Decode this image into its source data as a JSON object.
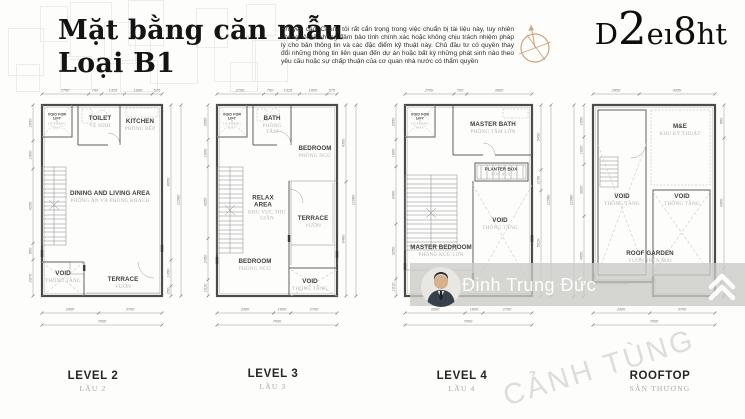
{
  "header": {
    "title_line1": "Mặt bằng căn mẫu",
    "title_line2": "Loại B1",
    "disclaimer": "Khuyến cáo: Chúng tôi rất cẩn trọng trong việc chuẩn bị tài liệu này, tuy nhiên chúng tôi sẽ không đảm bảo tính chính xác hoặc không chịu trách nhiệm pháp lý cho bản thông tin và các đặc điểm kỹ thuật này. Chủ đầu tư có quyền thay đổi những thông tin liên quan đến dự án hoặc bất kỳ những phát sinh nào theo yêu cầu hoặc sự chấp thuận của cơ quan nhà nước có thẩm quyền",
    "logo_parts": [
      "D",
      "2",
      "eı",
      "8",
      "ht"
    ]
  },
  "watermark": {
    "agent_name": "Đinh Trung Đức",
    "diagonal_text": "CẢNH TÙNG"
  },
  "colors": {
    "compass_tan": "#cfa27c",
    "watermark_bar": "#cbcac6"
  },
  "plans": [
    {
      "label": "LEVEL 2",
      "label_vn": "LẦU 2",
      "rooms": {
        "lift_en": "VOID FOR LIFT",
        "lift_vn": "LÔ THANG MÁY",
        "toilet_en": "TOILET",
        "toilet_vn": "VỆ SINH",
        "kitchen_en": "KITCHEN",
        "kitchen_vn": "PHÒNG BẾP",
        "dining_en": "DINING AND LIVING AREA",
        "dining_vn": "PHÒNG ĂN VÀ PHÒNG KHÁCH",
        "void_en": "VOID",
        "void_vn": "THÔNG TẦNG",
        "terrace_en": "TERRACE",
        "terrace_vn": "VƯỜN"
      },
      "dims_top": [
        "2700",
        "760",
        "1325",
        "1600",
        "575"
      ],
      "dims_left": [
        "2050",
        "1600",
        "4250",
        "950",
        "2070"
      ],
      "dims_right": [
        "8650",
        "1450",
        "250"
      ],
      "dim_right_total": "11080",
      "dims_bottom": [
        "3300",
        "3700"
      ],
      "dim_bottom_total": "7000"
    },
    {
      "label": "LEVEL 3",
      "label_vn": "LẦU 3",
      "rooms": {
        "lift_en": "VOID FOR LIFT",
        "lift_vn": "LÔ THANG MÁY",
        "bath_en": "BATH",
        "bath_vn": "PHÒNG TẮM",
        "bedroom1_en": "BEDROOM",
        "bedroom1_vn": "PHÒNG NGỦ",
        "relax_en": "RELAX AREA",
        "relax_vn": "KHU VỰC THƯ GIÃN",
        "terrace_en": "TERRACE",
        "terrace_vn": "VƯỜN",
        "bedroom2_en": "BEDROOM",
        "bedroom2_vn": "PHÒNG NGỦ",
        "void_en": "VOID",
        "void_vn": "THÔNG TẦNG"
      },
      "dims_top": [
        "2700",
        "760",
        "1325",
        "1600",
        "575"
      ],
      "dims_left": [
        "2050",
        "1600",
        "4250",
        "2450",
        "1010"
      ],
      "dims_right": [
        "4350",
        "6480"
      ],
      "dim_right_total": "11080",
      "dims_bottom": [
        "3300",
        "1000",
        "2700"
      ],
      "dim_bottom_total": "7000"
    },
    {
      "label": "LEVEL 4",
      "label_vn": "LẦU 4",
      "rooms": {
        "lift_en": "VOID FOR LIFT",
        "lift_vn": "LÔ THANG MÁY",
        "masterbath_en": "MASTER BATH",
        "masterbath_vn": "PHÒNG TẮM LỚN",
        "planter_en": "PLANTER BOX",
        "planter_vn": "BỒN HOA",
        "masterbed_en": "MASTER BEDROOM",
        "masterbed_vn": "PHÒNG NGỦ LỚN",
        "void_en": "VOID",
        "void_vn": "THÔNG TẦNG"
      },
      "dims_top": [
        "2700",
        "700",
        "3600"
      ],
      "dims_left": [
        "2050",
        "1600",
        "3400",
        "3250",
        "1010"
      ],
      "dims_right": [
        "3450",
        "1100",
        "5610"
      ],
      "dim_right_total": "11080",
      "dims_bottom": [
        "3300",
        "1000",
        "2700"
      ],
      "dim_bottom_total": "7000"
    },
    {
      "label": "ROOFTOP",
      "label_vn": "SÂN THƯỢNG",
      "rooms": {
        "me_en": "M&E",
        "me_vn": "KHU KỸ THUẬT",
        "voidl_en": "VOID",
        "voidl_vn": "THÔNG TẦNG",
        "voidr_en": "VOID",
        "voidr_vn": "THÔNG TẦNG",
        "roofgarden_en": "ROOF GARDEN",
        "roofgarden_vn": "VƯỜN TRÊN MÁI"
      },
      "dims_top": [
        "2650",
        "4350"
      ],
      "dims_left": [
        "1850",
        "1600",
        "3000",
        "4050"
      ],
      "dim_left_total": "11080",
      "dims_right": [
        "950",
        "4350",
        "1400"
      ],
      "dims_bottom": [
        "3300",
        "3700"
      ],
      "dim_bottom_total": "7000"
    }
  ]
}
